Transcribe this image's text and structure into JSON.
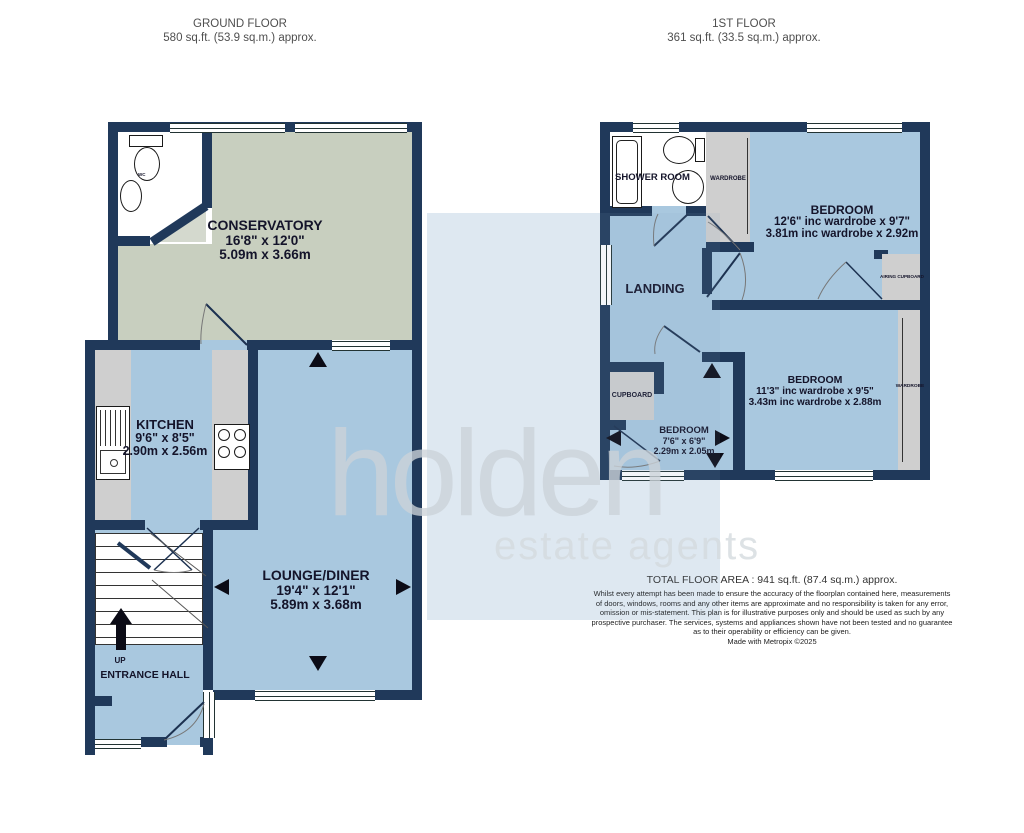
{
  "ground_floor": {
    "title": "GROUND FLOOR",
    "area": "580 sq.ft. (53.9 sq.m.) approx.",
    "rooms": {
      "conservatory": {
        "name": "CONSERVATORY",
        "dims_imperial": "16'8\" x 12'0\"",
        "dims_metric": "5.09m x 3.66m"
      },
      "kitchen": {
        "name": "KITCHEN",
        "dims_imperial": "9'6\" x 8'5\"",
        "dims_metric": "2.90m x 2.56m"
      },
      "lounge": {
        "name": "LOUNGE/DINER",
        "dims_imperial": "19'4\" x 12'1\"",
        "dims_metric": "5.89m x 3.68m"
      },
      "entrance_hall": {
        "name": "ENTRANCE HALL",
        "stairs_direction": "UP"
      },
      "wc": {
        "name": "WC"
      }
    }
  },
  "first_floor": {
    "title": "1ST FLOOR",
    "area": "361 sq.ft. (33.5 sq.m.) approx.",
    "rooms": {
      "shower_room": {
        "name": "SHOWER ROOM"
      },
      "bedroom1": {
        "name": "BEDROOM",
        "dims_imperial": "12'6\" inc wardrobe x 9'7\"",
        "dims_metric": "3.81m inc wardrobe x 2.92m"
      },
      "bedroom2": {
        "name": "BEDROOM",
        "dims_imperial": "11'3\" inc wardrobe x 9'5\"",
        "dims_metric": "3.43m inc wardrobe x 2.88m"
      },
      "bedroom3": {
        "name": "BEDROOM",
        "dims_imperial": "7'6\" x 6'9\"",
        "dims_metric": "2.29m x 2.05m"
      },
      "landing": {
        "name": "LANDING"
      },
      "cupboard": {
        "name": "CUPBOARD"
      },
      "airing_cupboard": {
        "name": "AIRING CUPBOARD"
      },
      "wardrobe_front": {
        "name": "WARDROBE"
      },
      "wardrobe_rear": {
        "name": "WARDROBE"
      }
    }
  },
  "footer": {
    "total_area": "TOTAL FLOOR AREA : 941 sq.ft. (87.4 sq.m.) approx.",
    "disclaimer": [
      "Whilst every attempt has been made to ensure the accuracy of the floorplan contained here, measurements",
      "of doors, windows, rooms and any other items are approximate and no responsibility is taken for any error,",
      "omission or mis-statement. This plan is for illustrative purposes only and should be used as such by any",
      "prospective purchaser. The services, systems and appliances shown have not been tested and no guarantee",
      "as to their operability or efficiency can be given.",
      "Made with Metropix ©2025"
    ]
  },
  "watermark": {
    "line1": "holden",
    "line2": "estate agents"
  },
  "colors": {
    "wall": "#20395a",
    "floor_blue": "#a9c8df",
    "floor_green": "#c8cfbf",
    "cupboard_grey": "#cfcfcf",
    "watermark_bg": "#e8f0f7"
  }
}
